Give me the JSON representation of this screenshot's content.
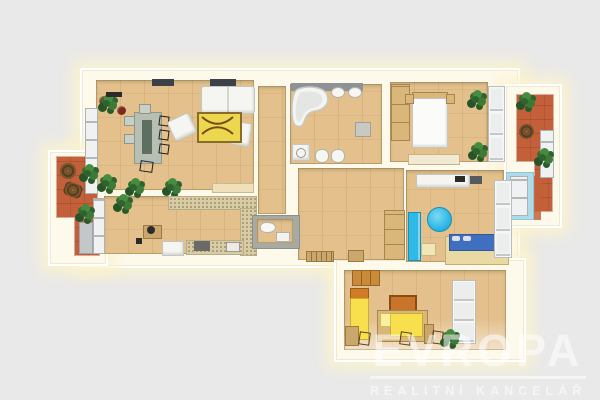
{
  "watermark": {
    "title": "EVROPA",
    "subtitle": "REALITNÍ KANCELÁŘ"
  },
  "colors": {
    "background": "#e9e9e9",
    "wall_cream": "#fdfaec",
    "wall_glow": "#f7edc3",
    "floor_wood": "#e3c08c",
    "terracotta": "#c3603a",
    "counter": "#d6cca6",
    "rug_yellow": "#ecd84f",
    "table_green": "#b7bfb2",
    "accent_cyan": "#2eb9e7",
    "bed_blue": "#3f6fbe",
    "kids_yellow": "#f7df4d",
    "plant_green": "#2f6230",
    "window_rust": "#b96a4e",
    "light_blue": "#aedbe8",
    "watermark_white": "#ffffff"
  }
}
